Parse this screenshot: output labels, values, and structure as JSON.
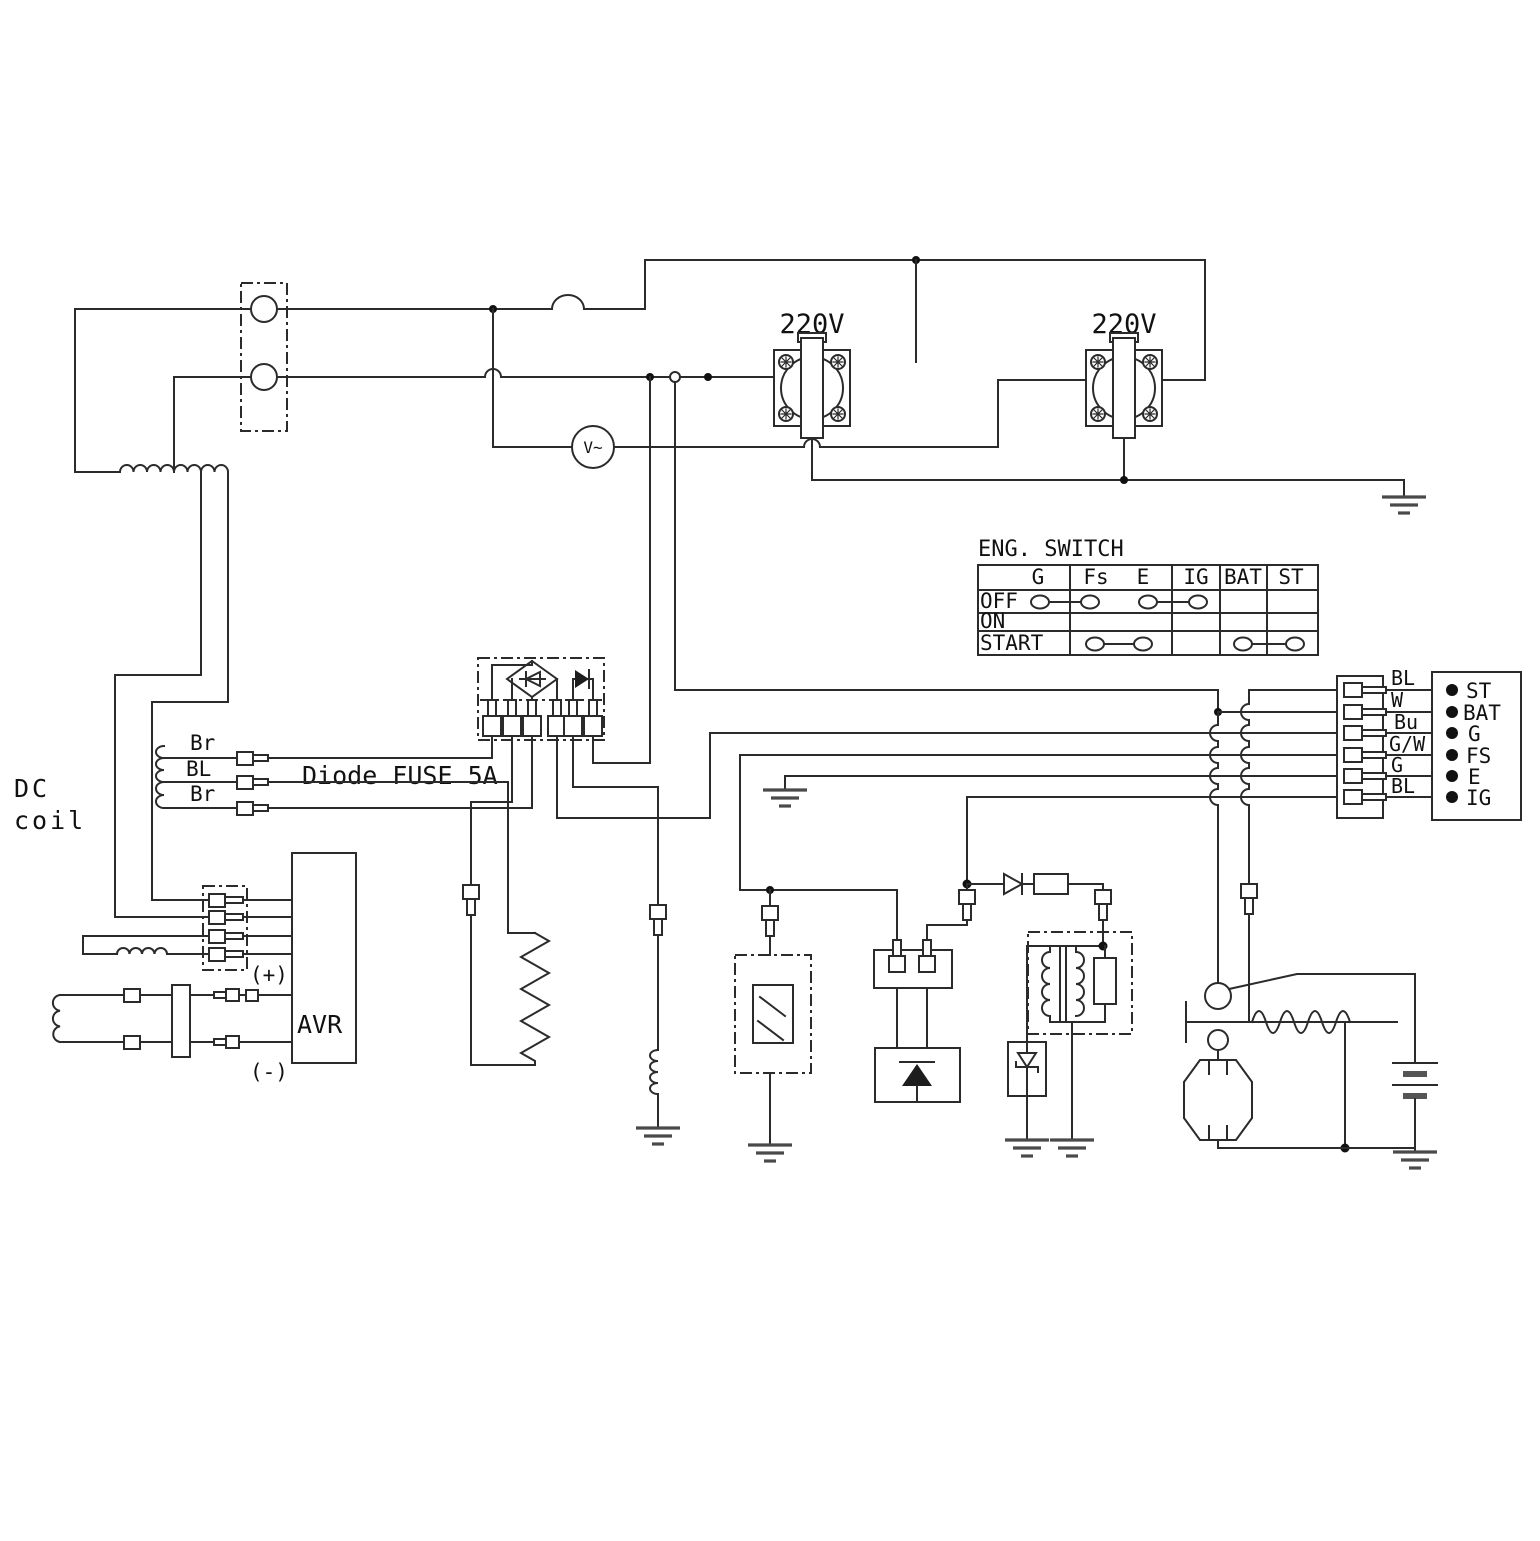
{
  "labels": {
    "dc_line1": "DC",
    "dc_line2": "coil",
    "diode_fuse": "Diode FUSE 5A",
    "avr": "AVR",
    "plus": "(+)",
    "minus": "(-)",
    "voltmeter": "V~",
    "outlet_left": "220V",
    "outlet_right": "220V"
  },
  "dc_coil_wires": [
    "Br",
    "BL",
    "Br"
  ],
  "eng_switch": {
    "title": "ENG. SWITCH",
    "columns": [
      "G",
      "Fs",
      "E",
      "IG",
      "BAT",
      "ST"
    ],
    "rows": [
      "OFF",
      "ON",
      "START"
    ],
    "contact_links": {
      "OFF": [
        [
          "G",
          "Fs"
        ],
        [
          "E",
          "IG"
        ]
      ],
      "ON": [],
      "START": [
        [
          "Fs",
          "E"
        ],
        [
          "BAT",
          "ST"
        ]
      ]
    }
  },
  "harness_labels": [
    "BL",
    "W",
    "Bu",
    "G/W",
    "G",
    "BL"
  ],
  "terminal_labels": [
    "ST",
    "BAT",
    "G",
    "FS",
    "E",
    "IG"
  ]
}
